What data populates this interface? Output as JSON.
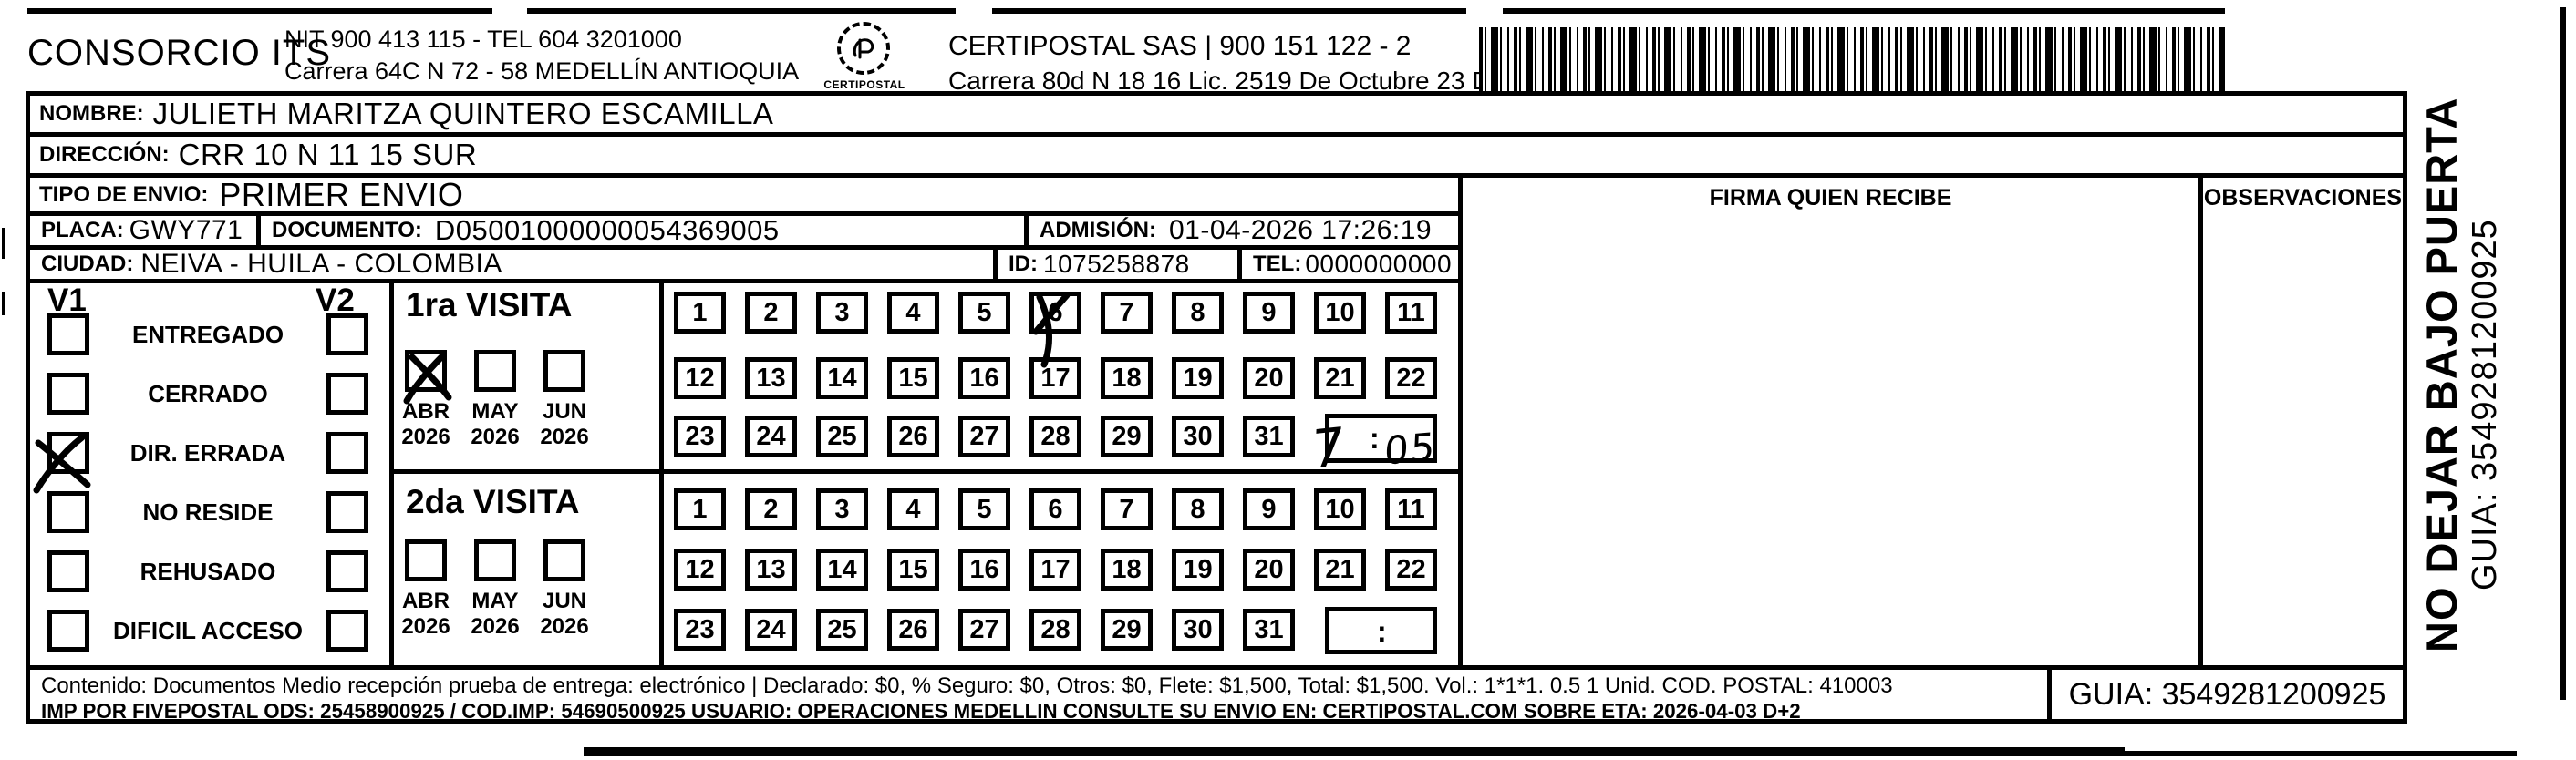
{
  "header": {
    "sender_name": "CONSORCIO ITS",
    "sender_nit_line": "NIT 900 413 115 - TEL 604 3201000",
    "sender_address_line": "Carrera 64C N 72 - 58 MEDELLÍN ANTIOQUIA",
    "logo_text": "CERTIPOSTAL",
    "carrier_line": "CERTIPOSTAL SAS | 900 151 122 - 2",
    "carrier_address_line": "Carrera 80d N 18 16  Lic. 2519 De Octubre 23 De 2015"
  },
  "recipient": {
    "nombre_label": "NOMBRE:",
    "nombre": "JULIETH MARITZA QUINTERO ESCAMILLA",
    "direccion_label": "DIRECCIÓN:",
    "direccion": "CRR 10 N 11 15 SUR",
    "tipo_envio_label": "TIPO DE ENVIO:",
    "tipo_envio": "PRIMER ENVIO",
    "placa_label": "PLACA:",
    "placa": "GWY771",
    "documento_label": "DOCUMENTO:",
    "documento": "D05001000000054369005",
    "admision_label": "ADMISIÓN:",
    "admision": "01-04-2026 17:26:19",
    "ciudad_label": "CIUDAD:",
    "ciudad": "NEIVA - HUILA - COLOMBIA",
    "id_label": "ID:",
    "id": "1075258878",
    "tel_label": "TEL:",
    "tel": "0000000000"
  },
  "columns": {
    "firma": "FIRMA QUIEN RECIBE",
    "observaciones": "OBSERVACIONES"
  },
  "status": {
    "v1_label": "V1",
    "v2_label": "V2",
    "options": [
      {
        "label": "ENTREGADO",
        "v1_checked": false,
        "v2_checked": false
      },
      {
        "label": "CERRADO",
        "v1_checked": false,
        "v2_checked": false
      },
      {
        "label": "DIR. ERRADA",
        "v1_checked": true,
        "v2_checked": false
      },
      {
        "label": "NO RESIDE",
        "v1_checked": false,
        "v2_checked": false
      },
      {
        "label": "REHUSADO",
        "v1_checked": false,
        "v2_checked": false
      },
      {
        "label": "DIFICIL ACCESO",
        "v1_checked": false,
        "v2_checked": false
      }
    ]
  },
  "visits": [
    {
      "title": "1ra VISITA",
      "months": [
        {
          "label": "ABR",
          "year": "2026",
          "checked": true
        },
        {
          "label": "MAY",
          "year": "2026",
          "checked": false
        },
        {
          "label": "JUN",
          "year": "2026",
          "checked": false
        }
      ],
      "days": [
        1,
        2,
        3,
        4,
        5,
        6,
        7,
        8,
        9,
        10,
        11,
        12,
        13,
        14,
        15,
        16,
        17,
        18,
        19,
        20,
        21,
        22,
        23,
        24,
        25,
        26,
        27,
        28,
        29,
        30,
        31
      ],
      "crossed_day": 6,
      "time": {
        "hour": "7",
        "separator": ":",
        "minutes": "05",
        "handwritten": true
      }
    },
    {
      "title": "2da VISITA",
      "months": [
        {
          "label": "ABR",
          "year": "2026",
          "checked": false
        },
        {
          "label": "MAY",
          "year": "2026",
          "checked": false
        },
        {
          "label": "JUN",
          "year": "2026",
          "checked": false
        }
      ],
      "days": [
        1,
        2,
        3,
        4,
        5,
        6,
        7,
        8,
        9,
        10,
        11,
        12,
        13,
        14,
        15,
        16,
        17,
        18,
        19,
        20,
        21,
        22,
        23,
        24,
        25,
        26,
        27,
        28,
        29,
        30,
        31
      ],
      "crossed_day": null,
      "time": {
        "hour": "",
        "separator": ":",
        "minutes": "",
        "handwritten": false
      }
    }
  ],
  "side_note": {
    "line1": "NO DEJAR BAJO PUERTA",
    "line2": "GUIA: 3549281200925"
  },
  "footer": {
    "line1": "Contenido: Documentos Medio recepción prueba de entrega: electrónico | Declarado: $0, % Seguro: $0, Otros: $0, Flete: $1,500, Total: $1,500. Vol.: 1*1*1. 0.5  1 Unid. COD. POSTAL: 410003",
    "line2": "IMP POR FIVEPOSTAL ODS: 25458900925 / COD.IMP: 54690500925 USUARIO: OPERACIONES MEDELLIN CONSULTE SU ENVIO EN: CERTIPOSTAL.COM SOBRE ETA: 2026-04-03 D+2",
    "guia_box": "GUIA: 3549281200925"
  },
  "ink_color": "#000000",
  "paper_color": "#ffffff"
}
